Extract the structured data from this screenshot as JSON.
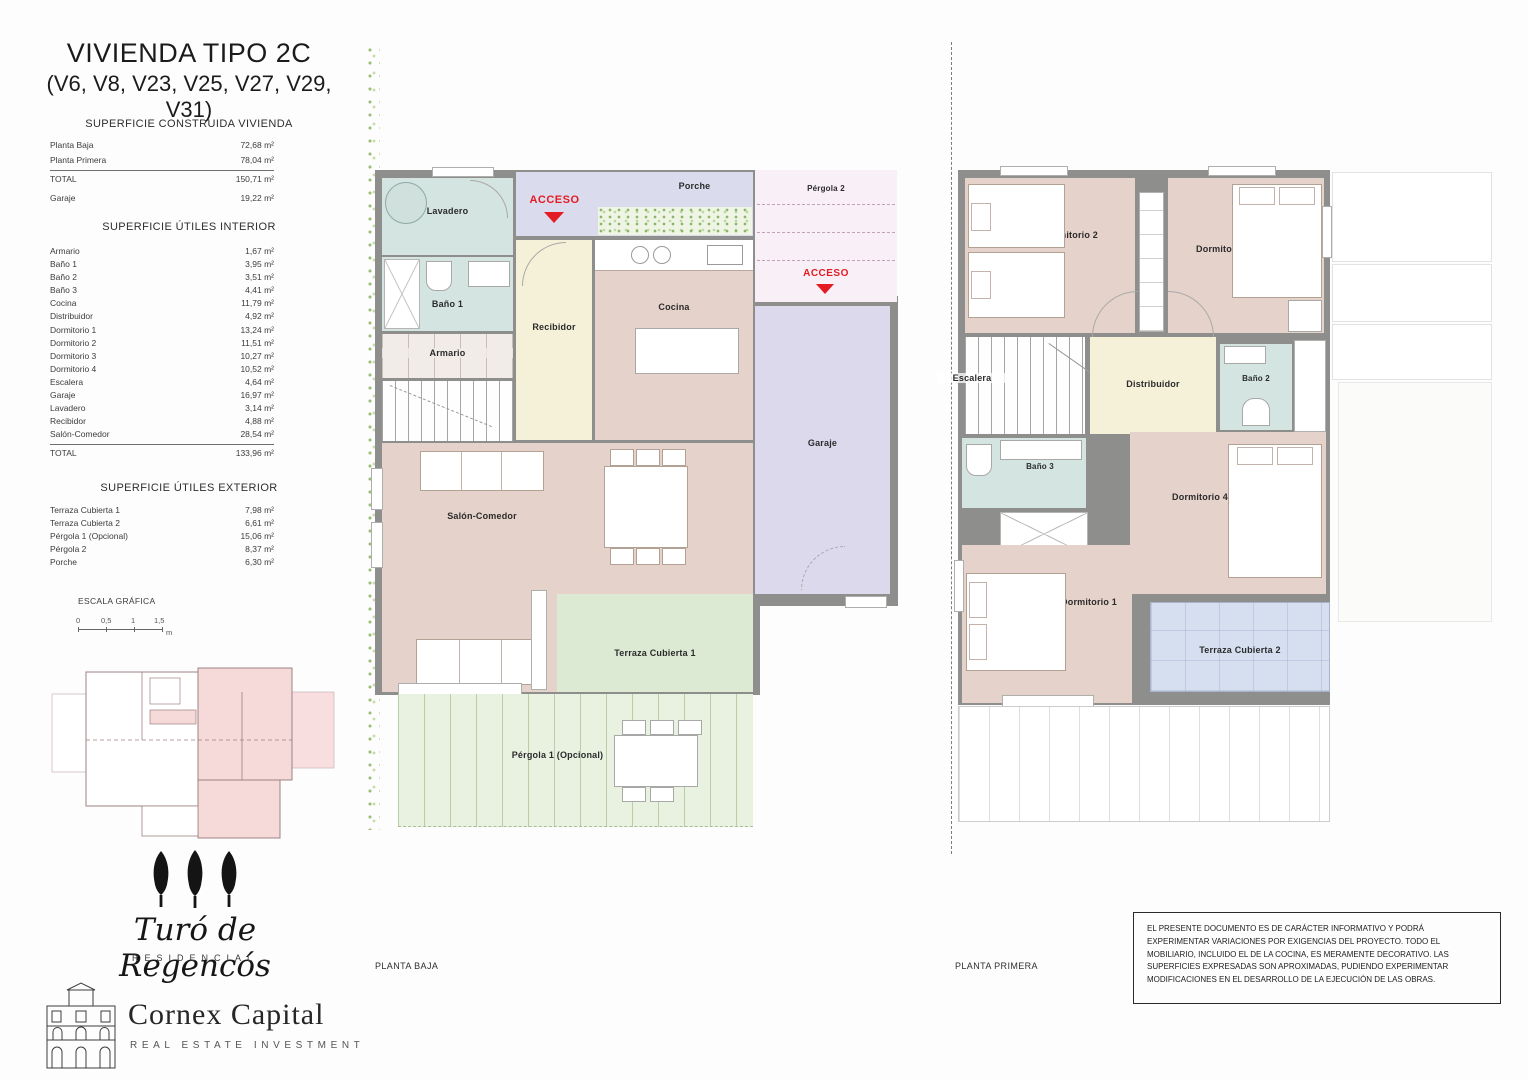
{
  "header": {
    "title": "VIVIENDA TIPO 2C",
    "subtitle": "(V6, V8, V23, V25, V27, V29, V31)"
  },
  "construida": {
    "heading": "SUPERFICIE CONSTRUIDA VIVIENDA",
    "rows": [
      {
        "label": "Planta Baja",
        "value": "72,68 m²"
      },
      {
        "label": "Planta Primera",
        "value": "78,04 m²"
      },
      {
        "label": "TOTAL",
        "value": "150,71 m²"
      },
      {
        "label": "Garaje",
        "value": "19,22 m²"
      }
    ]
  },
  "interior": {
    "heading": "SUPERFICIE ÚTILES INTERIOR",
    "rows": [
      {
        "label": "Armario",
        "value": "1,67 m²"
      },
      {
        "label": "Baño 1",
        "value": "3,95 m²"
      },
      {
        "label": "Baño 2",
        "value": "3,51 m²"
      },
      {
        "label": "Baño 3",
        "value": "4,41 m²"
      },
      {
        "label": "Cocina",
        "value": "11,79 m²"
      },
      {
        "label": "Distribuidor",
        "value": "4,92 m²"
      },
      {
        "label": "Dormitorio 1",
        "value": "13,24 m²"
      },
      {
        "label": "Dormitorio 2",
        "value": "11,51 m²"
      },
      {
        "label": "Dormitorio 3",
        "value": "10,27 m²"
      },
      {
        "label": "Dormitorio 4",
        "value": "10,52 m²"
      },
      {
        "label": "Escalera",
        "value": "4,64 m²"
      },
      {
        "label": "Garaje",
        "value": "16,97 m²"
      },
      {
        "label": "Lavadero",
        "value": "3,14 m²"
      },
      {
        "label": "Recibidor",
        "value": "4,88 m²"
      },
      {
        "label": "Salón-Comedor",
        "value": "28,54 m²"
      }
    ],
    "total": {
      "label": "TOTAL",
      "value": "133,96 m²"
    }
  },
  "exterior": {
    "heading": "SUPERFICIE ÚTILES EXTERIOR",
    "rows": [
      {
        "label": "Terraza Cubierta 1",
        "value": "7,98 m²"
      },
      {
        "label": "Terraza Cubierta 2",
        "value": "6,61 m²"
      },
      {
        "label": "Pérgola 1 (Opcional)",
        "value": "15,06 m²"
      },
      {
        "label": "Pérgola 2",
        "value": "8,37 m²"
      },
      {
        "label": "Porche",
        "value": "6,30 m²"
      }
    ]
  },
  "escala": {
    "heading": "ESCALA GRÁFICA",
    "ticks": [
      "0",
      "0,5",
      "1",
      "1,5"
    ],
    "unit": "m"
  },
  "plans": {
    "baja": {
      "caption": "PLANTA BAJA",
      "acceso": "ACCESO",
      "rooms": {
        "lavadero": "Lavadero",
        "bano1": "Baño 1",
        "armario": "Armario",
        "recibidor": "Recibidor",
        "cocina": "Cocina",
        "porche": "Porche",
        "pergola2": "Pérgola 2",
        "garaje": "Garaje",
        "salon": "Salón-Comedor",
        "terraza1": "Terraza Cubierta 1",
        "pergola1": "Pérgola 1 (Opcional)"
      }
    },
    "primera": {
      "caption": "PLANTA PRIMERA",
      "rooms": {
        "dormitorio2": "Dormitorio 2",
        "dormitorio3": "Dormitorio 3",
        "escalera": "Escalera",
        "distribuidor": "Distribuidor",
        "bano2": "Baño 2",
        "bano3": "Baño 3",
        "dormitorio4": "Dormitorio 4",
        "dormitorio1": "Dormitorio 1",
        "terraza2": "Terraza Cubierta 2"
      }
    }
  },
  "branding": {
    "project": "Turó de Regencós",
    "project_sub": "RESIDENCIAL",
    "company": "Cornex Capital",
    "company_sub": "REAL ESTATE INVESTMENT"
  },
  "disclaimer": "EL PRESENTE DOCUMENTO ES DE CARÁCTER INFORMATIVO Y PODRÁ EXPERIMENTAR VARIACIONES POR EXIGENCIAS DEL PROYECTO. TODO EL MOBILIARIO, INCLUIDO EL DE LA COCINA, ES MERAMENTE DECORATIVO. LAS SUPERFICIES EXPRESADAS SON APROXIMADAS, PUDIENDO EXPERIMENTAR MODIFICACIONES EN EL DESARROLLO DE LA EJECUCIÓN DE LAS OBRAS.",
  "colors": {
    "wall": "#8e8e8c",
    "wet_room": "#d4e4e1",
    "living_room": "#e5d2ca",
    "hall": "#f5f1d8",
    "garage": "#dcd9ec",
    "porch": "#dadcee",
    "terrace_green": "#dcead3",
    "terrace_blue": "#d5dff0",
    "pergola_pink": "#f9eff6",
    "accent_red": "#e41b23"
  }
}
